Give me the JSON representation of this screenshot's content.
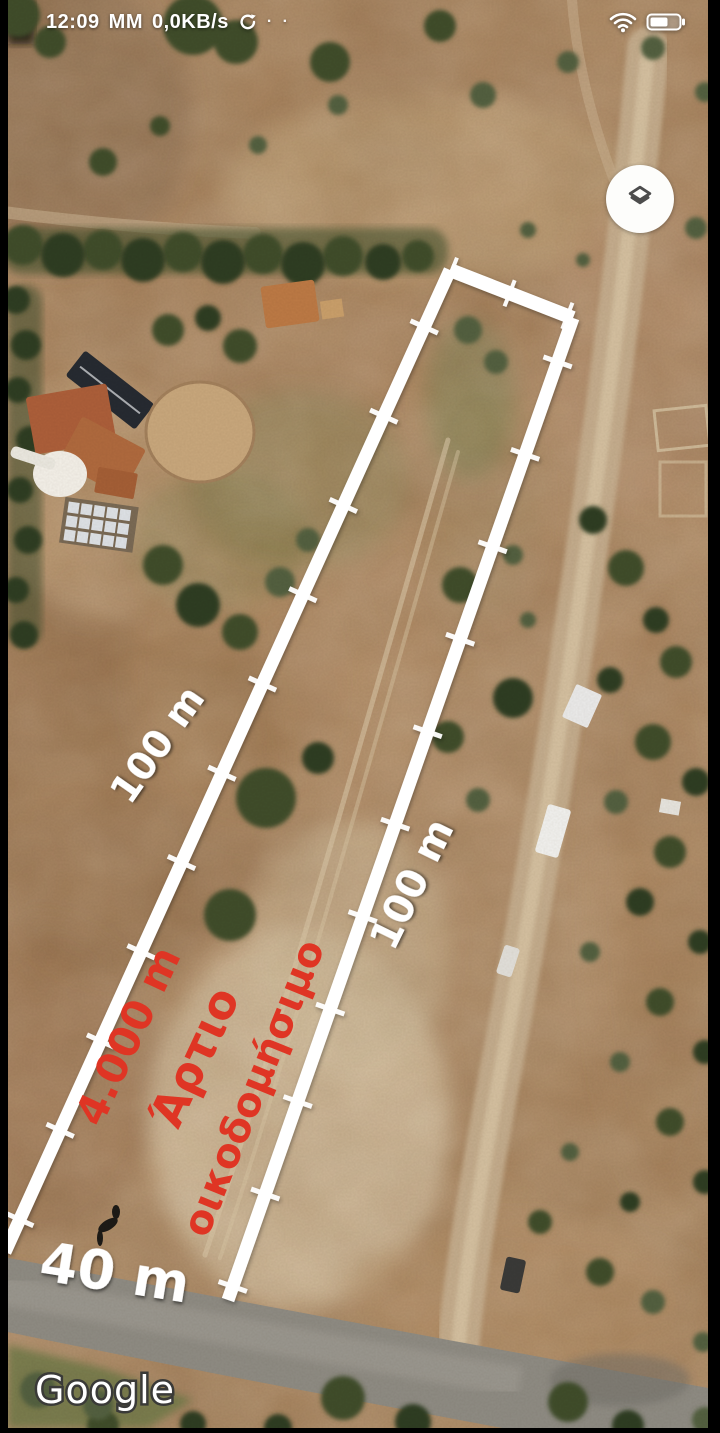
{
  "status_bar": {
    "time": "12:09",
    "network_label": "MM",
    "data_rate": "0,0KB/s",
    "dots": "· ·",
    "icons": [
      "sync-icon",
      "wifi-icon",
      "battery-icon"
    ]
  },
  "annotations": {
    "side_length_left": "100 m",
    "side_length_right": "100 m",
    "frontage_width": "40 m",
    "plot_area": "4.000 m",
    "zoning_word_1": "Άρτιο",
    "zoning_word_2": "οικοδομήσιμο",
    "colors": {
      "zoning_red": "#df3524",
      "dimension_white": "#ffffff",
      "road_gray": "#8f8c84"
    }
  },
  "watermark": {
    "brand": "Google"
  },
  "controls": {
    "layers_button_icon": "layers-icon"
  }
}
